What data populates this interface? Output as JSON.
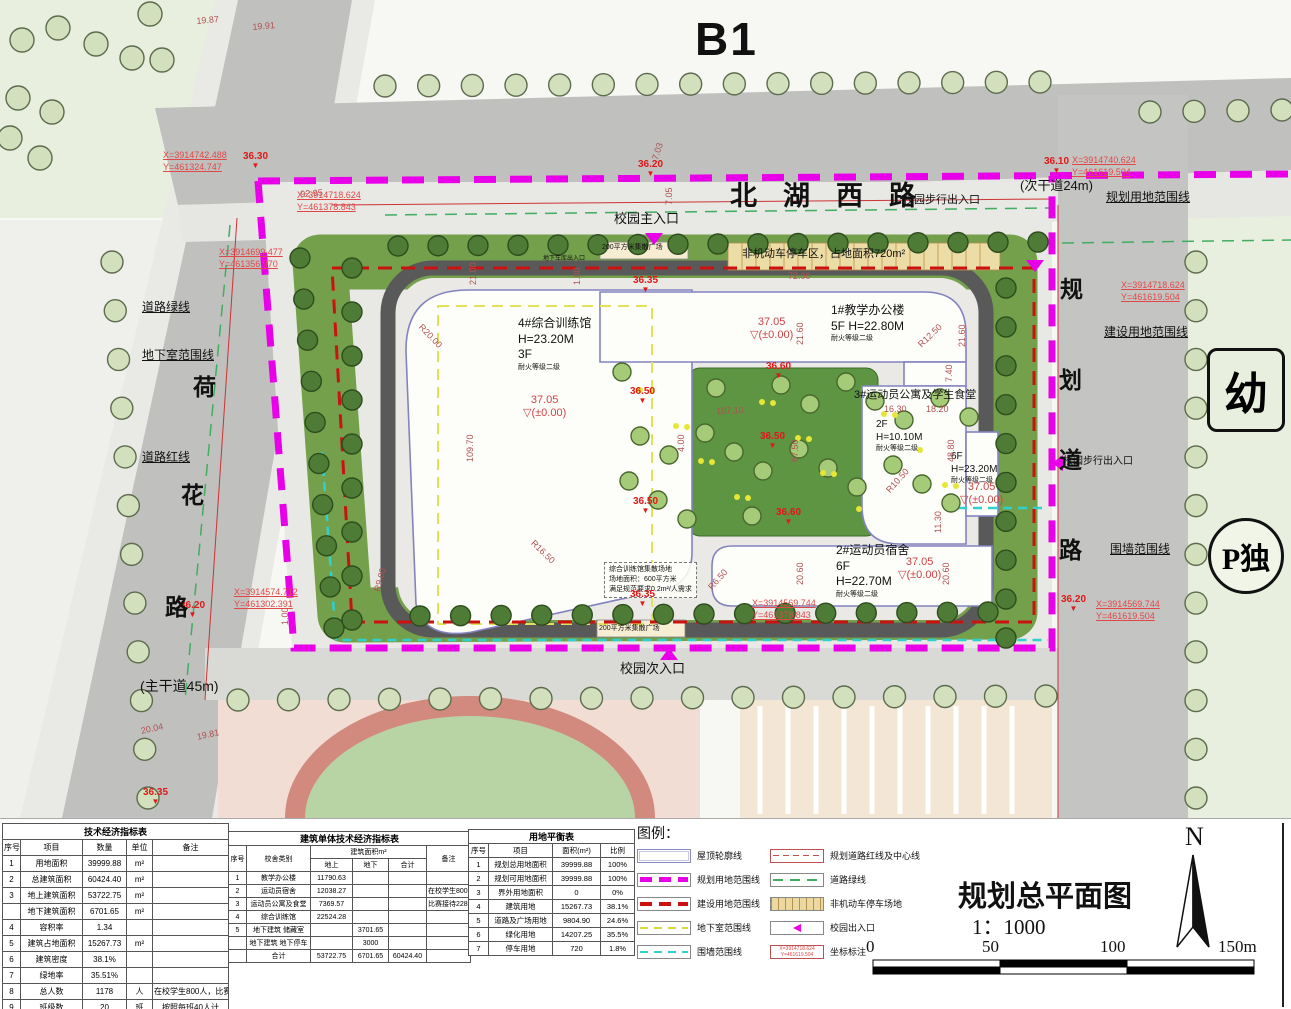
{
  "plan": {
    "zone_label": "B1",
    "roads": {
      "north": {
        "chars": [
          "北",
          "湖",
          "西",
          "路"
        ],
        "note": "(次干道24m)"
      },
      "west": {
        "chars": [
          "荷",
          "花",
          "路"
        ],
        "note": "(主干道45m)"
      },
      "east": {
        "chars": [
          "规",
          "划",
          "道",
          "路"
        ]
      }
    },
    "areas": {
      "kindergarten": "幼",
      "p_badge": "P独"
    },
    "text_labels": [
      {
        "t": "校园主入口",
        "x": 614,
        "y": 212,
        "s": 13
      },
      {
        "t": "校园步行出入口",
        "x": 903,
        "y": 194,
        "s": 11
      },
      {
        "t": "校园步行出入口",
        "x": 1063,
        "y": 456,
        "s": 10
      },
      {
        "t": "校园次入口",
        "x": 620,
        "y": 662,
        "s": 13
      },
      {
        "t": "非机动车停车区，占地面积720m²",
        "x": 742,
        "y": 248,
        "s": 11
      },
      {
        "t": "200平方米集散广场",
        "x": 602,
        "y": 244,
        "s": 7
      },
      {
        "t": "地下车库出入口",
        "x": 543,
        "y": 256,
        "s": 6
      },
      {
        "t": "200平方米集散广场",
        "x": 599,
        "y": 625,
        "s": 7
      },
      {
        "t": "道路绿线",
        "x": 142,
        "y": 301,
        "s": 12,
        "u": 1
      },
      {
        "t": "地下室范围线",
        "x": 142,
        "y": 349,
        "s": 12,
        "u": 1
      },
      {
        "t": "道路红线",
        "x": 142,
        "y": 451,
        "s": 12,
        "u": 1
      },
      {
        "t": "规划用地范围线",
        "x": 1106,
        "y": 191,
        "s": 12,
        "u": 1
      },
      {
        "t": "建设用地范围线",
        "x": 1104,
        "y": 326,
        "s": 12,
        "u": 1
      },
      {
        "t": "围墙范围线",
        "x": 1110,
        "y": 543,
        "s": 12,
        "u": 1
      }
    ],
    "blocks": [
      {
        "x": 518,
        "y": 316,
        "s": 12,
        "lines": [
          "4#综合训练馆",
          "H=23.20M",
          "3F"
        ],
        "small": "耐火等级二级"
      },
      {
        "x": 831,
        "y": 303,
        "s": 12,
        "lines": [
          "1#教学办公楼",
          "5F  H=22.80M"
        ],
        "small": "耐火等级二级"
      },
      {
        "x": 854,
        "y": 388,
        "s": 11,
        "lines": [
          "3#运动员公寓及学生食堂"
        ]
      },
      {
        "x": 876,
        "y": 418,
        "s": 10,
        "lines": [
          "2F",
          "H=10.10M"
        ],
        "small": "耐火等级二级"
      },
      {
        "x": 951,
        "y": 450,
        "s": 10,
        "lines": [
          "6F",
          "H=23.20M"
        ],
        "small": "耐火等级二级"
      },
      {
        "x": 836,
        "y": 543,
        "s": 12,
        "lines": [
          "2#运动员宿舍",
          "6F",
          "H=22.70M"
        ],
        "small": "耐火等级二级"
      },
      {
        "x": 604,
        "y": 562,
        "s": 7,
        "lines": [
          "综合训练馆集散场地",
          "场地面积：600平方米",
          "满足规范要求0.2m²/人需求"
        ],
        "box": 1
      }
    ],
    "spots": [
      {
        "t": "37.05",
        "sub": "(±0.00)",
        "x": 523,
        "y": 394
      },
      {
        "t": "37.05",
        "sub": "(±0.00)",
        "x": 750,
        "y": 316
      },
      {
        "t": "37.05",
        "sub": "(±0.00)",
        "x": 960,
        "y": 481
      },
      {
        "t": "37.05",
        "sub": "(±0.00)",
        "x": 898,
        "y": 556
      }
    ],
    "levels": [
      {
        "t": "36.30",
        "x": 243,
        "y": 152
      },
      {
        "t": "36.20",
        "x": 638,
        "y": 160
      },
      {
        "t": "36.10",
        "x": 1044,
        "y": 157
      },
      {
        "t": "36.20",
        "x": 180,
        "y": 601
      },
      {
        "t": "36.20",
        "x": 1061,
        "y": 595
      },
      {
        "t": "36.35",
        "x": 633,
        "y": 276
      },
      {
        "t": "36.35",
        "x": 630,
        "y": 590
      },
      {
        "t": "36.35",
        "x": 143,
        "y": 788
      },
      {
        "t": "36.50",
        "x": 630,
        "y": 387
      },
      {
        "t": "36.50",
        "x": 760,
        "y": 432
      },
      {
        "t": "36.50",
        "x": 633,
        "y": 497
      },
      {
        "t": "36.60",
        "x": 766,
        "y": 362
      },
      {
        "t": "36.60",
        "x": 776,
        "y": 508
      }
    ],
    "dims": [
      {
        "t": "19.87",
        "x": 196,
        "y": 16,
        "r": -5
      },
      {
        "t": "19.91",
        "x": 252,
        "y": 22,
        "r": -5
      },
      {
        "t": "92.95",
        "x": 300,
        "y": 189,
        "r": -4
      },
      {
        "t": "7.03",
        "x": 650,
        "y": 158,
        "r": -72
      },
      {
        "t": "7.05",
        "x": 664,
        "y": 205,
        "r": -90
      },
      {
        "t": "72.00",
        "x": 788,
        "y": 271,
        "r": 0
      },
      {
        "t": "21.00",
        "x": 468,
        "y": 285,
        "r": -90
      },
      {
        "t": "1.00",
        "x": 572,
        "y": 285,
        "r": -90
      },
      {
        "t": "109.70",
        "x": 465,
        "y": 462,
        "r": -90
      },
      {
        "t": "R20.00",
        "x": 424,
        "y": 322,
        "r": 46
      },
      {
        "t": "R16.50",
        "x": 536,
        "y": 538,
        "r": 44
      },
      {
        "t": "R9.00",
        "x": 372,
        "y": 590,
        "r": -75
      },
      {
        "t": "R12.50",
        "x": 916,
        "y": 342,
        "r": -44
      },
      {
        "t": "21.60",
        "x": 795,
        "y": 345,
        "r": -90
      },
      {
        "t": "21.60",
        "x": 957,
        "y": 347,
        "r": -90
      },
      {
        "t": "7.40",
        "x": 944,
        "y": 382,
        "r": -90
      },
      {
        "t": "16.30",
        "x": 884,
        "y": 404,
        "r": 0
      },
      {
        "t": "18.20",
        "x": 926,
        "y": 404,
        "r": 0
      },
      {
        "t": "48.80",
        "x": 946,
        "y": 462,
        "r": -90
      },
      {
        "t": "R10.50",
        "x": 884,
        "y": 488,
        "r": -48
      },
      {
        "t": "R6.50",
        "x": 706,
        "y": 585,
        "r": -48
      },
      {
        "t": "20.60",
        "x": 795,
        "y": 585,
        "r": -90
      },
      {
        "t": "20.60",
        "x": 941,
        "y": 585,
        "r": -90
      },
      {
        "t": "11.30",
        "x": 933,
        "y": 533,
        "r": -90
      },
      {
        "t": "107.10",
        "x": 716,
        "y": 406,
        "r": -2
      },
      {
        "t": "67.50",
        "x": 790,
        "y": 462,
        "r": -90
      },
      {
        "t": "4.00",
        "x": 676,
        "y": 452,
        "r": -90
      },
      {
        "t": "20.04",
        "x": 140,
        "y": 726,
        "r": -12
      },
      {
        "t": "19.81",
        "x": 196,
        "y": 732,
        "r": -12
      },
      {
        "t": "1.00",
        "x": 280,
        "y": 625,
        "r": -90
      }
    ],
    "coords": [
      {
        "l1": "X=3914742.488",
        "l2": "Y=461324.747",
        "x": 163,
        "y": 150
      },
      {
        "l1": "X=3914718.624",
        "l2": "Y=461378.843",
        "x": 297,
        "y": 190
      },
      {
        "l1": "X=3914699.477",
        "l2": "Y=461356.970",
        "x": 219,
        "y": 247
      },
      {
        "l1": "X=3914574.712",
        "l2": "Y=461302.391",
        "x": 234,
        "y": 587
      },
      {
        "l1": "X=3914740.624",
        "l2": "Y=461619.504",
        "x": 1072,
        "y": 155
      },
      {
        "l1": "X=3914718.624",
        "l2": "Y=461619.504",
        "x": 1121,
        "y": 280
      },
      {
        "l1": "X=3914569.744",
        "l2": "Y=461619.504",
        "x": 1096,
        "y": 599
      },
      {
        "l1": "X=3914569.744",
        "l2": "Y=461378.843",
        "x": 752,
        "y": 598
      }
    ],
    "entrances": [
      {
        "x": 645,
        "y": 233,
        "dir": "down"
      },
      {
        "x": 1026,
        "y": 260,
        "dir": "down"
      },
      {
        "x": 1052,
        "y": 455,
        "dir": "left"
      },
      {
        "x": 660,
        "y": 648,
        "dir": "up"
      }
    ]
  },
  "tables": {
    "t1": {
      "title": "技术经济指标表",
      "headers": [
        "序号",
        "项目",
        "数量",
        "单位",
        "备注"
      ],
      "rows": [
        [
          "1",
          "用地面积",
          "39999.88",
          "m²",
          ""
        ],
        [
          "2",
          "总建筑面积",
          "60424.40",
          "m²",
          ""
        ],
        [
          "3",
          "地上建筑面积",
          "53722.75",
          "m²",
          ""
        ],
        [
          "",
          "地下建筑面积",
          "6701.65",
          "m²",
          ""
        ],
        [
          "4",
          "容积率",
          "1.34",
          "",
          ""
        ],
        [
          "5",
          "建筑占地面积",
          "15267.73",
          "m²",
          ""
        ],
        [
          "6",
          "建筑密度",
          "38.1%",
          "",
          ""
        ],
        [
          "7",
          "绿地率",
          "35.51%",
          "",
          ""
        ],
        [
          "8",
          "总人数",
          "1178",
          "人",
          "在校学生800人，比赛228人"
        ],
        [
          "9",
          "班级数",
          "20",
          "班",
          "按照每班40人计"
        ],
        [
          "10",
          "机动车停车位",
          "30",
          "辆",
          "在校教师150人"
        ],
        [
          "11",
          "非机动车停车位",
          "412",
          "辆",
          ""
        ]
      ]
    },
    "t2": {
      "title": "建筑单体技术经济指标表",
      "col_seq": "序号",
      "col_type": "校舍类别",
      "col_area": "建筑面积m²",
      "col_up": "地上",
      "col_down": "地下",
      "col_total": "合计",
      "col_note": "备注",
      "rows": [
        [
          "1",
          "教学办公楼",
          "11790.63",
          "",
          "",
          ""
        ],
        [
          "2",
          "运动员宿舍",
          "12038.27",
          "",
          "",
          "在校学生800人"
        ],
        [
          "3",
          "运动员公寓及食堂",
          "7369.57",
          "",
          "",
          "比赛接待228人"
        ],
        [
          "4",
          "综合训练馆",
          "22524.28",
          "",
          "",
          ""
        ],
        [
          "5",
          "地下建筑 储藏室",
          "",
          "3701.65",
          "",
          ""
        ],
        [
          "",
          "地下建筑 地下停车",
          "",
          "3000",
          "",
          ""
        ],
        [
          "",
          "合计",
          "53722.75",
          "6701.65",
          "60424.40",
          ""
        ]
      ]
    },
    "t3": {
      "title": "用地平衡表",
      "headers": [
        "序号",
        "项目",
        "面积(m²)",
        "比例"
      ],
      "rows": [
        [
          "1",
          "规划总用地面积",
          "39999.88",
          "100%"
        ],
        [
          "2",
          "规划可用地面积",
          "39999.88",
          "100%"
        ],
        [
          "3",
          "界外用地面积",
          "0",
          "0%"
        ],
        [
          "4",
          "建筑用地",
          "15267.73",
          "38.1%"
        ],
        [
          "5",
          "道路及广场用地",
          "9804.90",
          "24.6%"
        ],
        [
          "6",
          "绿化用地",
          "14207.25",
          "35.5%"
        ],
        [
          "7",
          "停车用地",
          "720",
          "1.8%"
        ]
      ]
    }
  },
  "legend": {
    "title": "图例：",
    "left": [
      {
        "label": "屋顶轮廓线",
        "style": "roof"
      },
      {
        "label": "规划用地范围线",
        "style": "mag"
      },
      {
        "label": "建设用地范围线",
        "style": "red"
      },
      {
        "label": "地下室范围线",
        "style": "yel"
      },
      {
        "label": "围墙范围线",
        "style": "cyan"
      }
    ],
    "right": [
      {
        "label": "规划道路红线及中心线",
        "style": "roadred"
      },
      {
        "label": "道路绿线",
        "style": "green"
      },
      {
        "label": "非机动车停车场地",
        "style": "tan"
      },
      {
        "label": "校园出入口",
        "style": "entry"
      },
      {
        "label": "坐标标注",
        "style": "coord",
        "sample1": "X=3914718.624",
        "sample2": "Y=461619.504"
      }
    ]
  },
  "titleblock": {
    "title": "规划总平面图",
    "scale": "1：1000",
    "north": "N",
    "scalebar": [
      "0",
      "50",
      "100",
      "150m"
    ]
  }
}
